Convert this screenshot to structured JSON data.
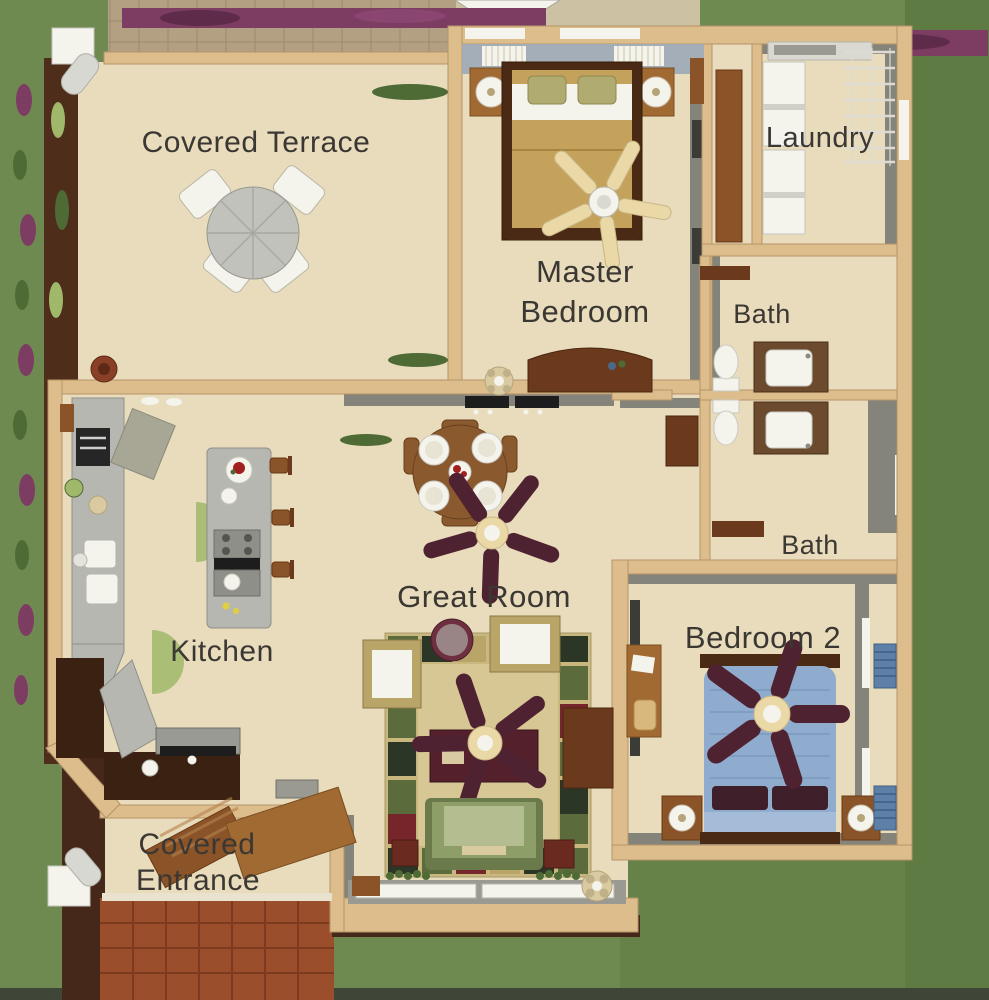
{
  "rooms": [
    {
      "id": "covered-terrace",
      "label": "Covered Terrace"
    },
    {
      "id": "master-bedroom",
      "label": "Master Bedroom",
      "lines": [
        "Master",
        "Bedroom"
      ]
    },
    {
      "id": "laundry",
      "label": "Laundry"
    },
    {
      "id": "bath-upper",
      "label": "Bath"
    },
    {
      "id": "bath-lower",
      "label": "Bath"
    },
    {
      "id": "kitchen",
      "label": "Kitchen"
    },
    {
      "id": "great-room",
      "label": "Great Room"
    },
    {
      "id": "bedroom-2",
      "label": "Bedroom 2"
    },
    {
      "id": "covered-entrance",
      "label": "Covered Entrance",
      "lines": [
        "Covered",
        "Entrance"
      ]
    }
  ],
  "colors": {
    "grass": "#6f8a51",
    "grass_dark": "#5e7b44",
    "soil": "#46281a",
    "planting": "#4f2d1b",
    "flower": "#7d3c62",
    "patio": "#b3a083",
    "patio_line": "#9c8a6e",
    "pavement": "#cdc1a3",
    "brick": "#9a4e2b",
    "brick_line": "#7c3a1f",
    "floor": "#e8dcbc",
    "wall": "#dcbd8b",
    "wall_edge": "#b6946a",
    "gray_wall": "#84847b",
    "gray_dark": "#3c3c36",
    "gray_light": "#a9a9a1",
    "white": "#f4f3ec",
    "granite": "#b7b7b2",
    "granite_edge": "#8f8f88",
    "espresso": "#3a2112",
    "wood": "#a06a32",
    "wood_mid": "#8a5328",
    "wood_dark": "#6b3a1c",
    "wood_deep": "#4a2a14",
    "table_wood": "#8a5a2e",
    "fan_maroon": "#4f2232",
    "fan_cream": "#ead8a6",
    "blanket": "#c5a25c",
    "pillow_olive": "#b0ab70",
    "window_band": "#a3aeb9",
    "bed_blue": "#8fabce",
    "bed_blue_light": "#a5bcd8",
    "pillow_maroon": "#3f1f2a",
    "shutter": "#5d80a8",
    "sofa": "#8e9e68",
    "sofa_light": "#b3bd90",
    "sofa_dark": "#6b7a4b",
    "rug": "#c8b87e",
    "rug_field": "#d6c795",
    "rug_green": "#5c6b3c",
    "rug_darkgreen": "#2c3626",
    "rug_red": "#76252b",
    "rug_tan": "#b8a567",
    "side_table": "#6e3040",
    "coffee": "#53202c",
    "plant": "#9fb86a",
    "plant_dark": "#4e6b35",
    "vanity": "#6b4a2e",
    "deco": "#d9caa2",
    "label": "#3b3733"
  }
}
